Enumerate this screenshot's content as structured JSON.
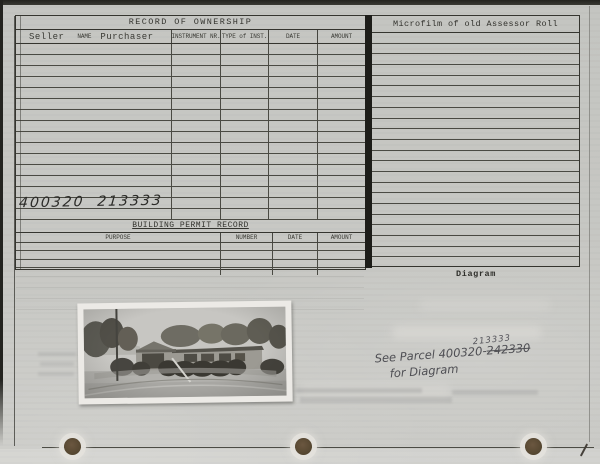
{
  "page": {
    "ownership": {
      "title": "RECORD OF OWNERSHIP",
      "col_seller": "Seller",
      "col_name": "NAME",
      "col_purchaser": "Purchaser",
      "col_instrument": "INSTRUMENT NR.",
      "col_type": "TYPE of INST.",
      "col_date": "DATE",
      "col_amount": "AMOUNT",
      "row_count": 16,
      "handwritten_parcel": "400320  213333"
    },
    "permits": {
      "title": "BUILDING PERMIT RECORD",
      "col_purpose": "PURPOSE",
      "col_number": "NUMBER",
      "col_date": "DATE",
      "col_amount": "AMOUNT",
      "row_count": 4
    },
    "microfilm": {
      "title": "Microfilm of old Assessor Roll",
      "row_count": 22
    },
    "diagram_label": "Diagram",
    "handwritten_note": {
      "line1_prefix": "See Parcel 400320-",
      "old_parcel": "242330",
      "new_parcel": "213333",
      "line2": "for Diagram"
    }
  },
  "colors": {
    "paper": "#c6c7c3",
    "table_line": "#45453f",
    "heavy_line": "#35352f",
    "divider": "#1d1d19",
    "typewriter_ink": "#2e2e2a",
    "pencil": "#4f4f54",
    "punch_hole": "#5e4c39",
    "photo_border": "#eceae6"
  }
}
